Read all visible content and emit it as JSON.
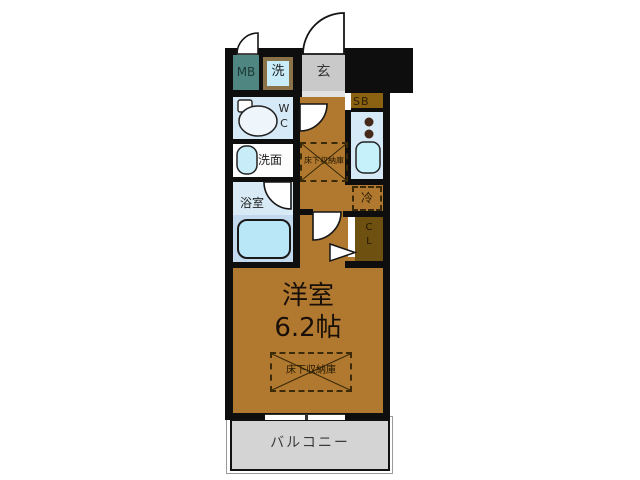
{
  "title": "floor-plan",
  "rooms": {
    "meter_box": {
      "label": "MB"
    },
    "washer": {
      "label": "洗"
    },
    "entrance": {
      "label": "玄"
    },
    "shoe_box": {
      "label": "SB"
    },
    "toilet": {
      "line1": "W",
      "line2": "C"
    },
    "washroom": {
      "label": "洗面"
    },
    "bathroom": {
      "label": "浴室"
    },
    "refrigerator": {
      "label": "冷"
    },
    "closet": {
      "line1": "C",
      "line2": "L"
    },
    "main_room": {
      "name": "洋室",
      "size": "6.2帖"
    },
    "underfloor_storage_hall": {
      "label": "床下収納庫"
    },
    "underfloor_storage_room": {
      "label": "床下収納庫"
    },
    "balcony": {
      "label": "バルコニー"
    }
  },
  "colors": {
    "wall": "#0e0e0e",
    "floor_brown": "#b1792f",
    "wet_room_blue": "#d6e9f6",
    "fixture_cyan": "#c2ecfa",
    "meter_box_teal": "#4f8682",
    "entrance_gray": "#c9c9c9",
    "balcony_gray": "#d4d4d4",
    "closet_brown": "#6e5110",
    "shoebox_brown": "#8a6212",
    "bathtub_zone_blue": "#c3d9ed"
  }
}
